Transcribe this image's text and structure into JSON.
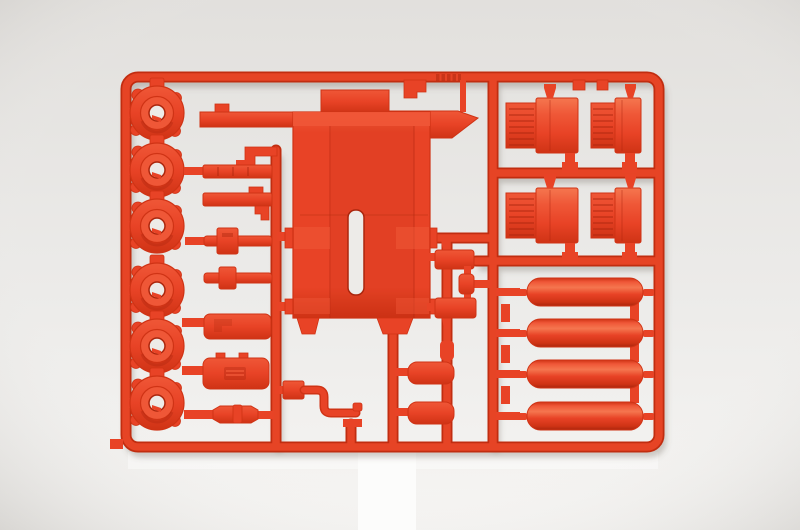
{
  "scene": {
    "type": "photograph",
    "subject": "Plastic model kit parts sprue molded in bright red-orange styrene, photographed on a neutral light-gray studio background with a white strip below the frame",
    "colors": {
      "bg-top": "#e2e0dd",
      "bg-mid": "#ecebe9",
      "bg-bottom": "#f6f5f3",
      "vignette": "rgba(110,104,96,0.22)",
      "white-strip": "#fcfcfb",
      "sheen": "rgba(255,255,255,0.40)",
      "plastic-base": "#e84326",
      "plastic-light": "#ef5737",
      "plastic-bright": "#f5764f",
      "plastic-dark": "#cf3315",
      "plastic-deep": "#ab260d",
      "runner-top": "#e64425",
      "runner-edge": "#c12d10",
      "hole": "#edebe8",
      "shadow": "rgba(99,90,80,0.30)"
    }
  },
  "sprue": {
    "material": "red-orange styrene",
    "frame_shape": "rounded rectangle runner frame",
    "parts_inventory": [
      {
        "name": "wheel-hub",
        "count": 6,
        "location": "left column"
      },
      {
        "name": "tie-bar",
        "count": 2,
        "location": "second column, top"
      },
      {
        "name": "axle-with-center-block",
        "count": 2,
        "location": "second column, middle"
      },
      {
        "name": "muffler-box",
        "count": 1,
        "location": "second column, lower"
      },
      {
        "name": "battery-box",
        "count": 1,
        "location": "second column, lower"
      },
      {
        "name": "small-rod",
        "count": 1,
        "location": "second column, bottom"
      },
      {
        "name": "chassis-plate-with-slot",
        "count": 1,
        "location": "center"
      },
      {
        "name": "radiator-block",
        "count": 4,
        "location": "upper right, two rows of two"
      },
      {
        "name": "small-block-bracket",
        "count": 5,
        "location": "center right"
      },
      {
        "name": "exhaust-pipe",
        "count": 1,
        "location": "bottom center"
      },
      {
        "name": "cylindrical-air-tank",
        "count": 4,
        "location": "right column"
      }
    ]
  }
}
